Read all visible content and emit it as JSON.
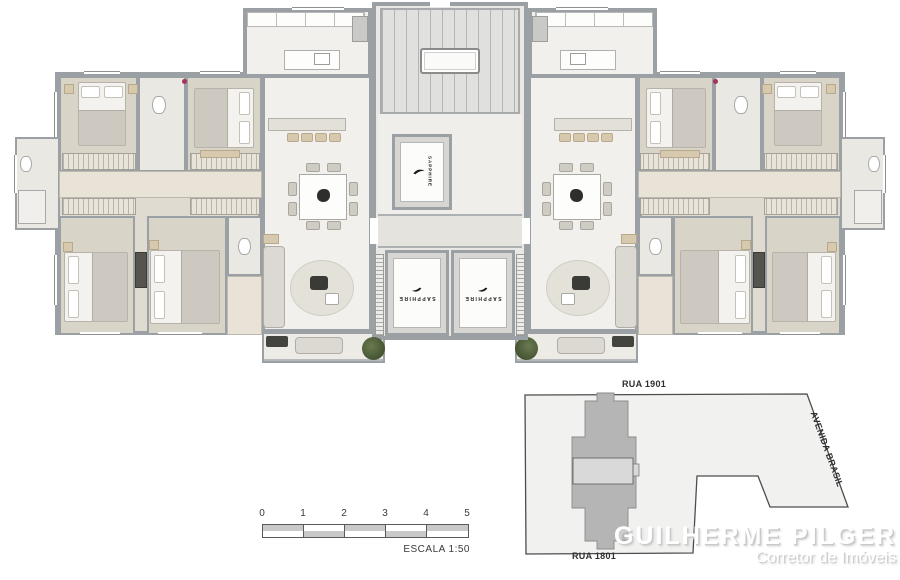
{
  "floor_plan": {
    "elevator_brand": "SAPPHIRE"
  },
  "scale_bar": {
    "ticks": [
      "0",
      "1",
      "2",
      "3",
      "4",
      "5"
    ],
    "label": "ESCALA 1:50"
  },
  "site_plan": {
    "street_top": "RUA 1901",
    "street_bottom": "RUA 1801",
    "street_right": "AVENIDA BRASIL"
  },
  "branding": {
    "name": "GUILHERME PILGER",
    "subtitle": "Corretor de Imóveis"
  },
  "colors": {
    "wall": "#9aa0a3",
    "plant": "#435230",
    "brand_shadow": "#cacaca",
    "site_lot": "#f1f1f0",
    "site_building": "#b5b5b5"
  }
}
